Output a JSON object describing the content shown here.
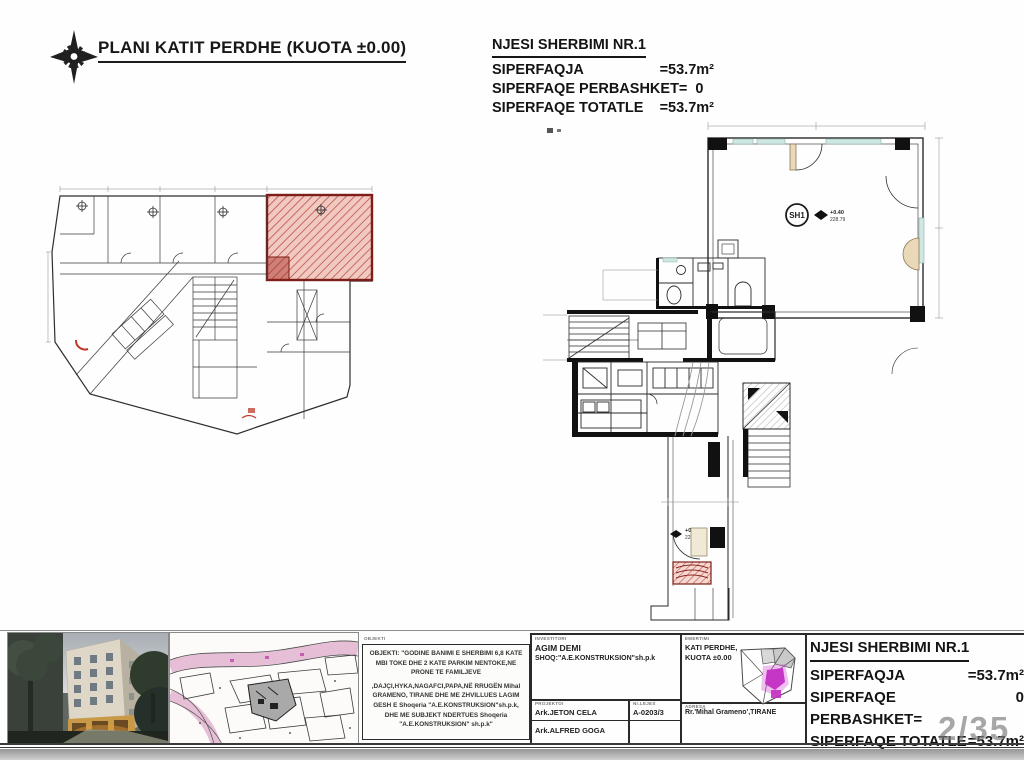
{
  "page": {
    "number": "2/35"
  },
  "header": {
    "plan_title": "PLANI KATIT PERDHE (KUOTA ±0.00)"
  },
  "summary": {
    "title": "NJESI SHERBIMI NR.1",
    "area_label": "SIPERFAQJA",
    "area_value": "=53.7m²",
    "common_label": "SIPERFAQE PERBASHKET=",
    "common_value": "0",
    "total_label": "SIPERFAQE TOTATLE",
    "total_value": "=53.7m²"
  },
  "plan_right": {
    "unit_label": "SH1",
    "level_main": "+0.40",
    "elev_main": "228.79",
    "level_entry": "+0.44",
    "elev_entry": "228.79"
  },
  "titleblock": {
    "object_label": "OBJEKTI",
    "object_lines": [
      "OBJEKTI: \"GODINE  BANIMI E SHERBIMI 6,8 KATE",
      "MBI TOKE DHE 2 KATE PARKIM NENTOKE,NE",
      "PRONE TE FAMILJEVE",
      ",DAJÇI,HYKA,NAGAFCI,PAPA,NË RRUGËN Mihal",
      "GRAMENO, TIRANE DHE ME ZHVILLUES LAGIM",
      "GESH E Shoqeria \"A.E.KONSTRUKSION\"sh.p.k,",
      "DHE ME SUBJEKT NDERTUES  Shoqeria",
      "\"A.E.KONSTRUKSION\" sh.p.k\""
    ],
    "investor_label": "INVESTITORI",
    "investor_name": "AGIM DEMI",
    "investor_company": "SHOQ:\"A.E.KONSTRUKSION\"sh.p.k",
    "drafted_label": "PROJEKTOI",
    "license_label": "Nr.LEJES",
    "architect_1": "Ark.JETON CELA",
    "license_no": "A-0203/3",
    "architect_2": "Ark.ALFRED GOGA",
    "sheet_label": "EMERTIMI",
    "sheet_name_1": "KATI PERDHE,",
    "sheet_name_2": "KUOTA ±0.00",
    "address_label": "ADRESA",
    "address": "Rr.'Mihal Grameno',TIRANE"
  }
}
